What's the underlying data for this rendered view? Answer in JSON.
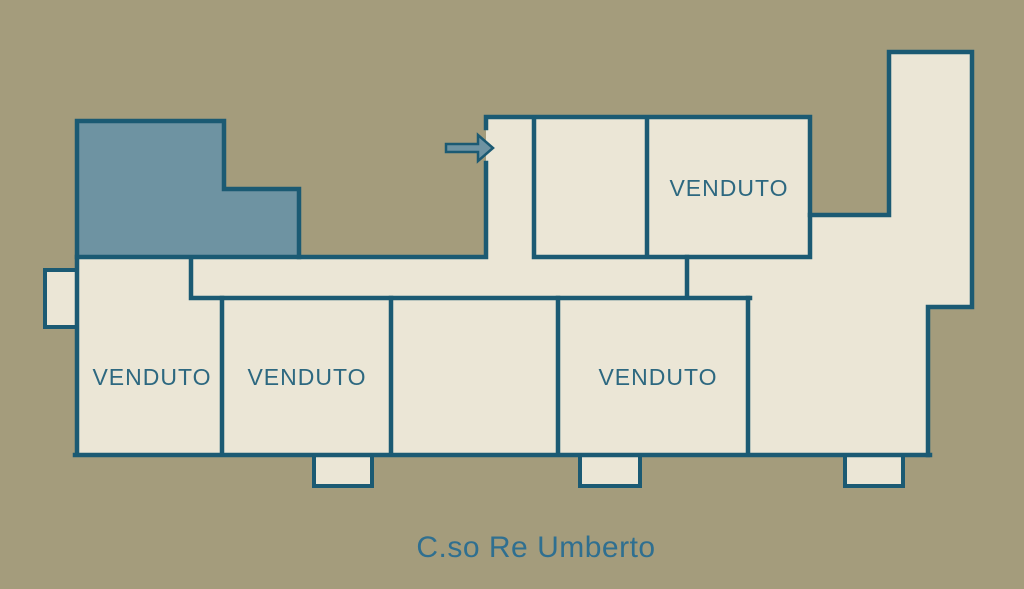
{
  "street_label": "C.so Re Umberto",
  "units": {
    "top": {
      "label": "VENDUTO"
    },
    "bottom_left": {
      "label": "VENDUTO"
    },
    "bottom_mid_left": {
      "label": "VENDUTO"
    },
    "bottom_mid_right": {
      "label": "VENDUTO"
    }
  },
  "icons": {
    "entrance_arrow": "right-arrow"
  },
  "colors": {
    "bg": "#a49c7c",
    "unit": "#ebe6d6",
    "wall": "#1b5a73",
    "highlight": "#6e93a2",
    "label": "#2d6880",
    "street": "#2f6f90"
  }
}
